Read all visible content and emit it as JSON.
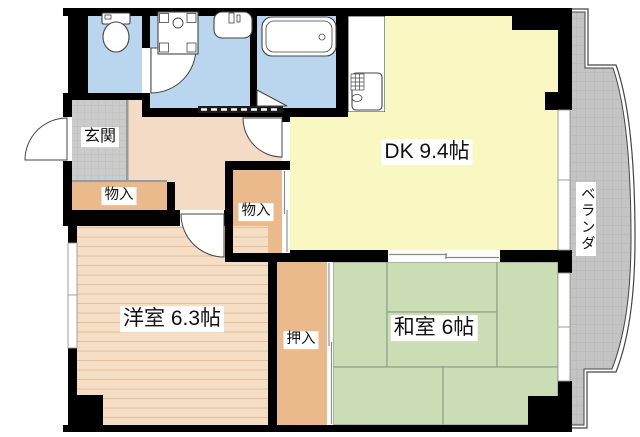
{
  "rooms": {
    "dk": {
      "label": "DK 9.4帖"
    },
    "western_room": {
      "label": "洋室 6.3帖"
    },
    "japanese_room": {
      "label": "和室 6帖"
    },
    "entrance": {
      "label": "玄関"
    },
    "storage_1": {
      "label": "物入"
    },
    "storage_2": {
      "label": "物入"
    },
    "closet": {
      "label": "押入"
    },
    "veranda": {
      "label": "ベランダ"
    }
  },
  "colors": {
    "wall": "#000000",
    "water_area": "#BAD5EE",
    "dk_floor": "#F9F7C2",
    "hall_floor": "#F3DBC6",
    "storage_floor": "#EBBA8C",
    "western_floor": "#F5DEC4",
    "western_floor_line": "#DCBD9D",
    "tatami": "#CADDB4",
    "tatami_line": "#95A58B",
    "entrance_tile": "#CBCBCB",
    "entrance_tile_line": "#BDBDBD",
    "veranda_floor": "#C4C4C4",
    "veranda_floor_line": "#B6B6B6",
    "outline": "#444444",
    "background": "#FFFFFF"
  }
}
